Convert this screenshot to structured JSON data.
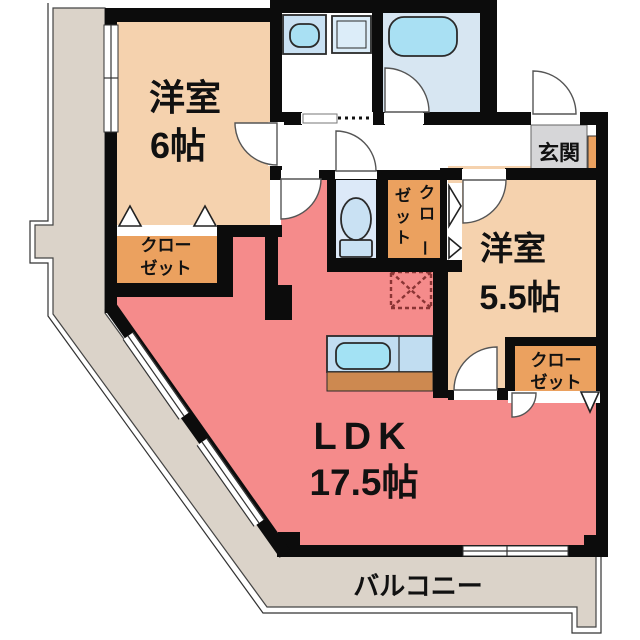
{
  "labels": {
    "bedroom6": {
      "name": "洋室",
      "size": "6帖"
    },
    "bedroom55": {
      "name": "洋室",
      "size": "5.5帖"
    },
    "ldk": {
      "name": "LDK",
      "size": "17.5帖"
    },
    "entrance": "玄関",
    "balcony": "バルコニー",
    "closet6": {
      "line1": "クロー",
      "line2": "ゼット"
    },
    "closet55": {
      "line1": "クロー",
      "line2": "ゼット"
    },
    "closet_hall": {
      "col_right": "クロー",
      "col_left": "ゼット"
    }
  },
  "fixtures": [
    "bathtub",
    "washbasin",
    "washing-machine-pan",
    "toilet",
    "kitchen-sink",
    "kitchen-counter",
    "refrigerator-space",
    "shoe-cabinet"
  ],
  "colors": {
    "walls": "#0c0c0c",
    "ldk": "#f58b8b",
    "bedroom": "#f5d2ae",
    "closet": "#eba15f",
    "balcony": "#dbd3c9",
    "genkan": "#d6d6d8",
    "water_room": "#d7e6f2",
    "toilet_floor": "#dce9f8",
    "fixture_blue": "#a9e0f3",
    "fixture_light": "#c9e1f3",
    "washer_pan": "#dcedf9",
    "kitchen_counter": "#c1ddf1",
    "kitchen_sink": "#a3e2f4",
    "kitchen_base": "#cd8950",
    "fridge_dash": "#8a3434"
  }
}
